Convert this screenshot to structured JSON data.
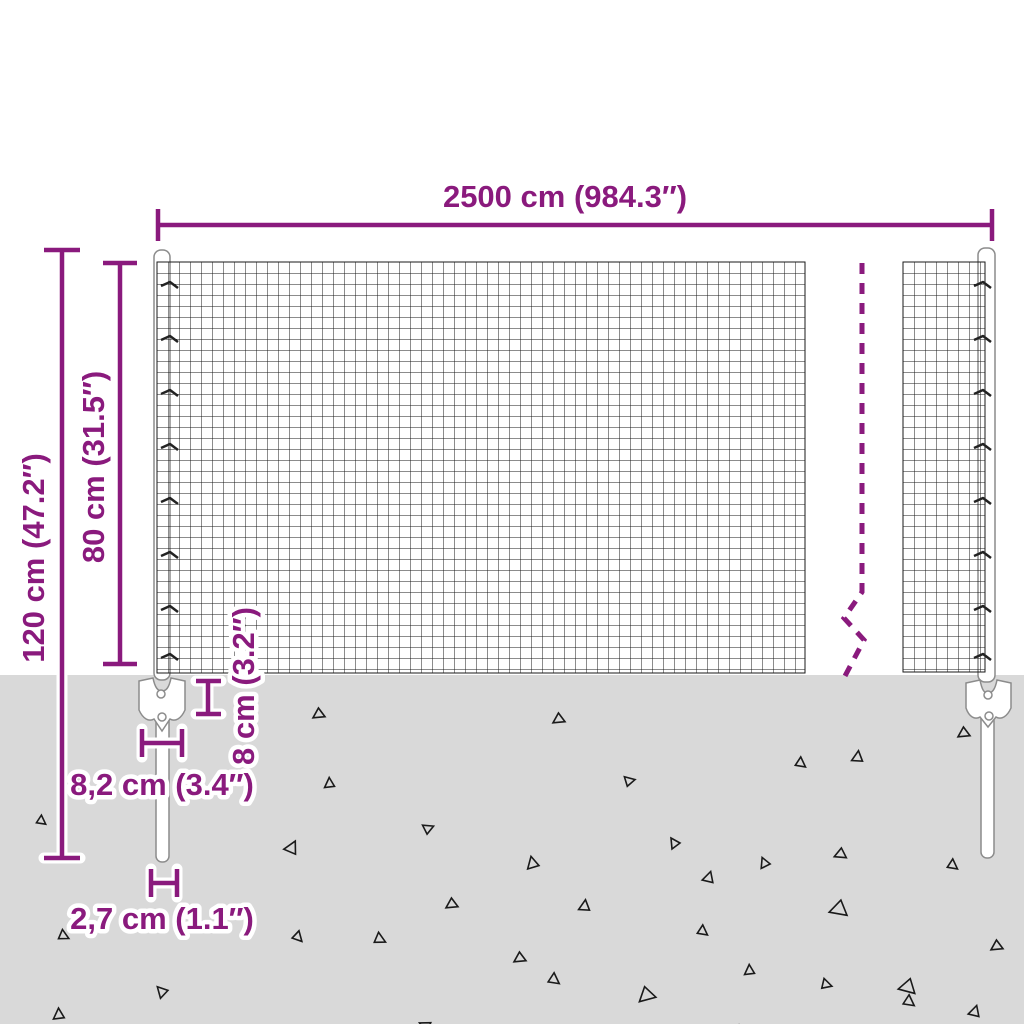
{
  "diagram": {
    "kind": "wire-mesh-fence-dimension-diagram",
    "labels": {
      "fence_width": "2500 cm (984.3″)",
      "total_height": "120 cm (47.2″)",
      "mesh_height": "80 cm (31.5″)",
      "anchor_depth": "8 cm (3.2″)",
      "plate_width": "8,2 cm (3.4″)",
      "post_diameter": "2,7 cm (1.1″)"
    }
  },
  "colors": {
    "accent": "#8A1A7D",
    "ground": "#D9D9D9",
    "mesh_line": "#1A1A1A",
    "post_fill": "#FFFFFF",
    "post_stroke": "#8C8C8C"
  },
  "decor": {
    "triangles": [
      [
        313,
        708,
        0,
        12
      ],
      [
        553,
        713,
        0,
        12
      ],
      [
        958,
        727,
        0,
        12
      ],
      [
        866,
        757,
        130,
        12
      ],
      [
        797,
        770,
        250,
        11
      ],
      [
        632,
        788,
        200,
        11
      ],
      [
        337,
        782,
        120,
        11
      ],
      [
        38,
        827,
        250,
        10
      ],
      [
        432,
        835,
        190,
        11
      ],
      [
        680,
        838,
        90,
        11
      ],
      [
        836,
        847,
        10,
        12
      ],
      [
        301,
        851,
        150,
        14
      ],
      [
        541,
        860,
        110,
        13
      ],
      [
        771,
        859,
        100,
        11
      ],
      [
        949,
        872,
        250,
        11
      ],
      [
        717,
        879,
        140,
        12
      ],
      [
        833,
        898,
        15,
        18
      ],
      [
        446,
        898,
        0,
        12
      ],
      [
        593,
        906,
        130,
        12
      ],
      [
        61,
        943,
        240,
        11
      ],
      [
        293,
        943,
        260,
        11
      ],
      [
        377,
        947,
        240,
        12
      ],
      [
        699,
        938,
        250,
        11
      ],
      [
        514,
        952,
        0,
        12
      ],
      [
        757,
        969,
        120,
        11
      ],
      [
        167,
        985,
        80,
        12
      ],
      [
        550,
        987,
        250,
        12
      ],
      [
        637,
        988,
        350,
        17
      ],
      [
        825,
        992,
        230,
        11
      ],
      [
        903,
        976,
        20,
        17
      ],
      [
        991,
        940,
        0,
        12
      ],
      [
        905,
        1009,
        250,
        12
      ],
      [
        734,
        1021,
        40,
        13
      ],
      [
        428,
        1018,
        60,
        12
      ],
      [
        67,
        1013,
        120,
        12
      ],
      [
        983,
        1013,
        140,
        12
      ]
    ],
    "clip_rows": [
      286,
      340,
      394,
      448,
      502,
      556,
      610,
      658
    ]
  }
}
